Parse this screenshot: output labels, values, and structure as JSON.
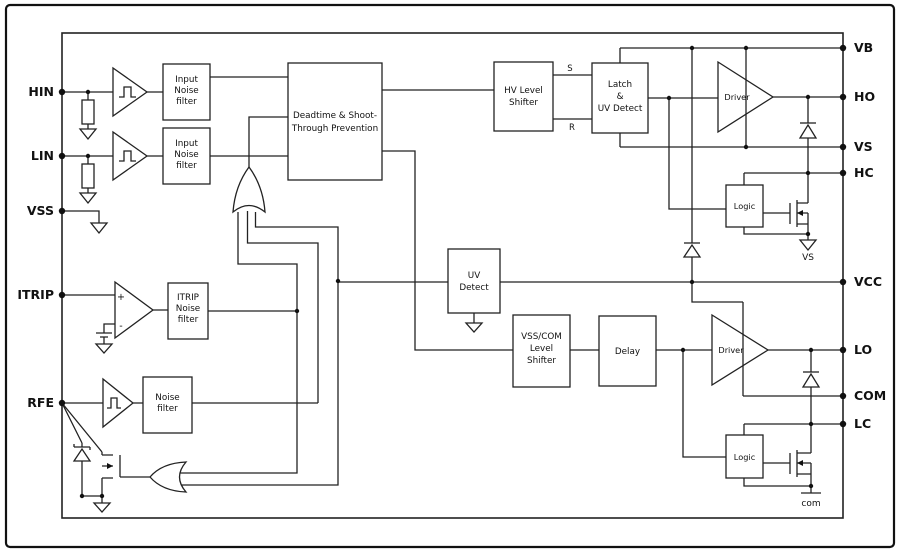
{
  "colors": {
    "line": "#222222",
    "background": "#ffffff",
    "text": "#111111"
  },
  "pins": {
    "left": {
      "hin": "HIN",
      "lin": "LIN",
      "vss": "VSS",
      "itrip": "ITRIP",
      "rfe": "RFE"
    },
    "right": {
      "vb": "VB",
      "ho": "HO",
      "vs": "VS",
      "hc": "HC",
      "vcc": "VCC",
      "lo": "LO",
      "com": "COM",
      "lc": "LC"
    }
  },
  "blocks": {
    "hin_filter": [
      "Input",
      "Noise",
      "filter"
    ],
    "lin_filter": [
      "Input",
      "Noise",
      "filter"
    ],
    "deadtime": [
      "Deadtime & Shoot-",
      "Through Prevention"
    ],
    "hv_shifter": [
      "HV Level",
      "Shifter"
    ],
    "latch": [
      "Latch",
      "&",
      "UV Detect"
    ],
    "driver_high": "Driver",
    "driver_low": "Driver",
    "logic_high": "Logic",
    "logic_low": "Logic",
    "uv_detect": [
      "UV",
      "Detect"
    ],
    "vsscom": [
      "VSS/COM",
      "Level",
      "Shifter"
    ],
    "delay": "Delay",
    "itrip_filter": [
      "ITRIP",
      "Noise",
      "filter"
    ],
    "rfe_filter": [
      "Noise",
      "filter"
    ]
  },
  "labels": {
    "set": "S",
    "reset": "R",
    "vs_reference": "VS",
    "com_reference": "com",
    "comparator_plus": "+",
    "comparator_minus": "-"
  }
}
